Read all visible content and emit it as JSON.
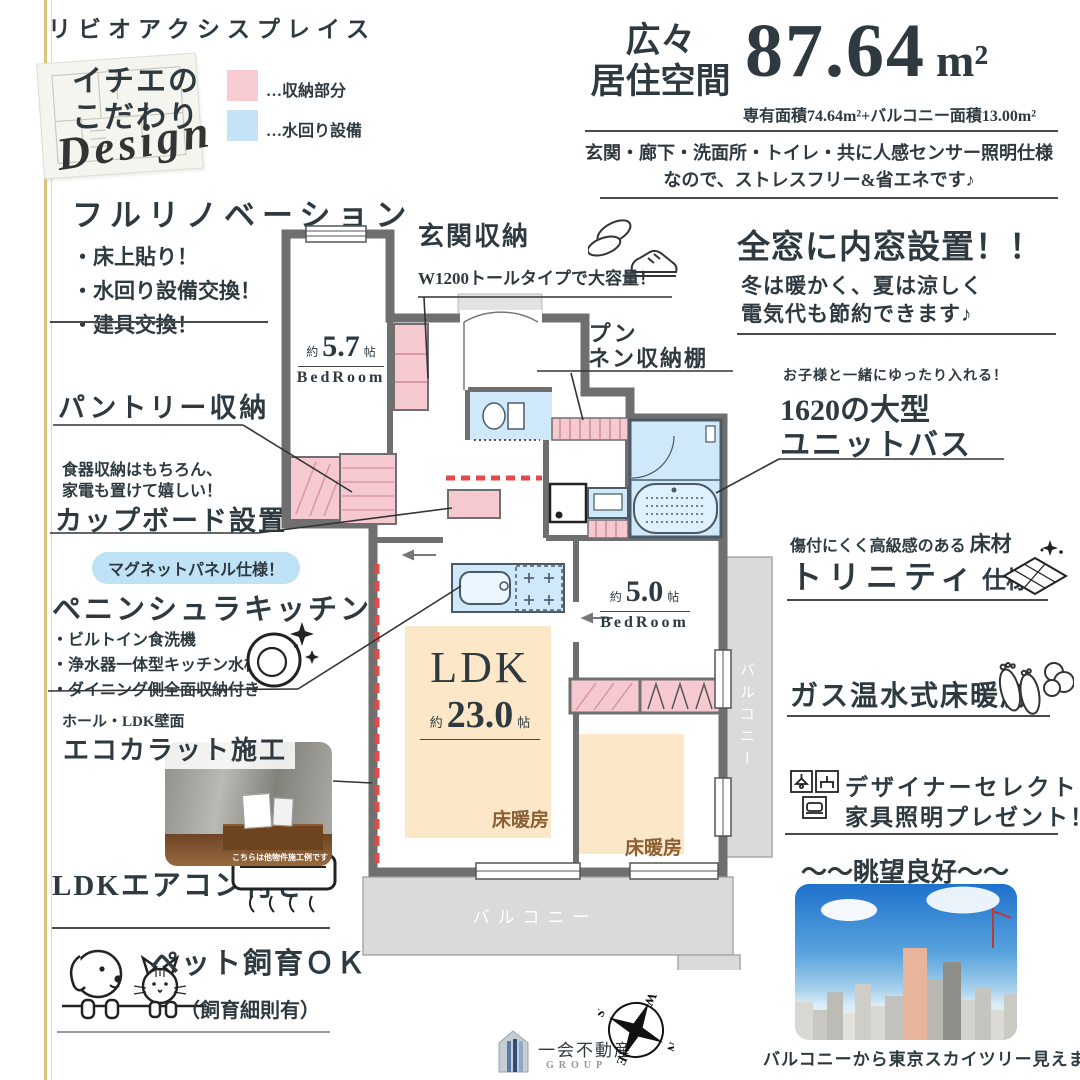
{
  "colors": {
    "storage_pink": "#f6c9d0",
    "plumbing_blue": "#cfe9fa",
    "wall_gray": "#6f6f6f",
    "accent_gold": "#d9c47e",
    "heated_floor_fill": "#fce8c8",
    "red_dash": "#e14b4b"
  },
  "header": {
    "building_name": "リビオアクシスプレイス",
    "badge": {
      "line1": "イチエの",
      "line2": "こだわり",
      "script": "Design"
    },
    "legend": {
      "storage_label": "…収納部分",
      "plumbing_label": "…水回り設備"
    }
  },
  "headline": {
    "spacious_line1": "広々",
    "spacious_line2": "居住空間",
    "area_value": "87.64",
    "area_unit": "m²",
    "area_detail": "専有面積74.64m²+バルコニー面積13.00m²",
    "sensor_line1": "玄関・廊下・洗面所・トイレ・共に人感センサー照明仕様",
    "sensor_line2": "なので、ストレスフリー&省エネです♪"
  },
  "left": {
    "renovation": {
      "title": "フルリノベーション",
      "items": [
        "・床上貼り！",
        "・水回り設備交換！",
        "・建具交換！"
      ]
    },
    "pantry": {
      "title": "パントリー収納"
    },
    "cupboard": {
      "note_line1": "食器収納はもちろん、",
      "note_line2": "家電も置けて嬉しい！",
      "title": "カップボード設置"
    },
    "kitchen": {
      "badge": "マグネットパネル仕様！",
      "title": "ペニンシュラキッチン",
      "items": [
        "・ビルトイン食洗機",
        "・浄水器一体型キッチン水栓",
        "・ダイニング側全面収納付き"
      ]
    },
    "ecocarat": {
      "note": "ホール・LDK壁面",
      "title": "エコカラット施工",
      "photo_caption": "こちらは他物件施工例です"
    },
    "aircon": {
      "title": "LDKエアコン付き"
    },
    "pet": {
      "title": "ペット飼育ＯＫ",
      "sub": "（飼育細則有）"
    }
  },
  "center": {
    "entrance_storage": {
      "title": "玄関収納",
      "sub": "W1200トールタイプで大容量！"
    },
    "linen": {
      "line1": "オープン",
      "line2": "リネン収納棚"
    }
  },
  "right": {
    "inner_window": {
      "title": "全窓に内窓設置！！",
      "line1": "冬は暖かく、夏は涼しく",
      "line2": "電気代も節約できます♪"
    },
    "unit_bath": {
      "note": "お子様と一緒にゆったり入れる！",
      "line1": "1620の大型",
      "line2": "ユニットバス"
    },
    "flooring": {
      "note": "傷付にくく高級感のある",
      "note_strong": "床材",
      "title": "トリニティ",
      "suffix": "仕様"
    },
    "heating": {
      "title": "ガス温水式床暖房"
    },
    "furniture": {
      "line1": "デザイナーセレクト",
      "line2": "家具照明プレゼント！"
    },
    "view": {
      "title": "～～眺望良好～～",
      "caption": "バルコニーから東京スカイツリー見えます！"
    }
  },
  "plan": {
    "bedroom1": {
      "approx": "約",
      "size": "5.7",
      "unit": "帖",
      "name": "BedRoom"
    },
    "bedroom2": {
      "approx": "約",
      "size": "5.0",
      "unit": "帖",
      "name": "BedRoom"
    },
    "ldk": {
      "name": "LDK",
      "approx": "約",
      "size": "23.0",
      "unit": "帖"
    },
    "floor_heating": "床暖房",
    "balcony_bottom": "バルコニー",
    "balcony_right": "バルコニー"
  },
  "footer": {
    "company": "一会不動産",
    "group": "GROUP",
    "compass": {
      "n": "N",
      "e": "E",
      "s": "S",
      "w": "W"
    }
  }
}
